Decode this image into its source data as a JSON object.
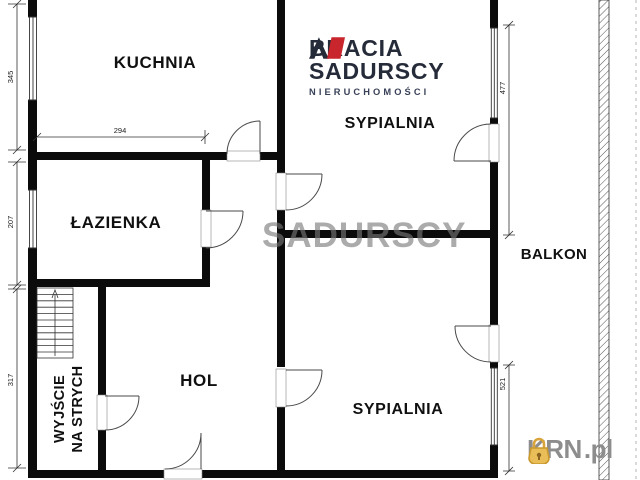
{
  "plan": {
    "rooms": {
      "kitchen": "KUCHNIA",
      "bedroom1": "SYPIALNIA",
      "bathroom": "ŁAZIENKA",
      "hall": "HOL",
      "bedroom2": "SYPIALNIA",
      "balcony": "BALKON",
      "attic_exit_line1": "WYJŚCIE",
      "attic_exit_line2": "NA STRYCH"
    },
    "dimensions": {
      "kitchen_height": "345",
      "kitchen_width": "294",
      "bathroom_height": "207",
      "hall_height": "317",
      "balcony_upper": "477",
      "balcony_lower": "521"
    }
  },
  "branding": {
    "agency": {
      "line1": "BRACIA",
      "line2": "SADURSCY",
      "line3": "NIERUCHOMOŚCI",
      "navy": "#262b3a",
      "red": "#c9252c"
    },
    "watermark": "SADURSCY",
    "portal": {
      "name": "KRN",
      "tld": ".pl",
      "lock_color": "#d9a43b",
      "text_color": "#8d8d8d"
    }
  }
}
